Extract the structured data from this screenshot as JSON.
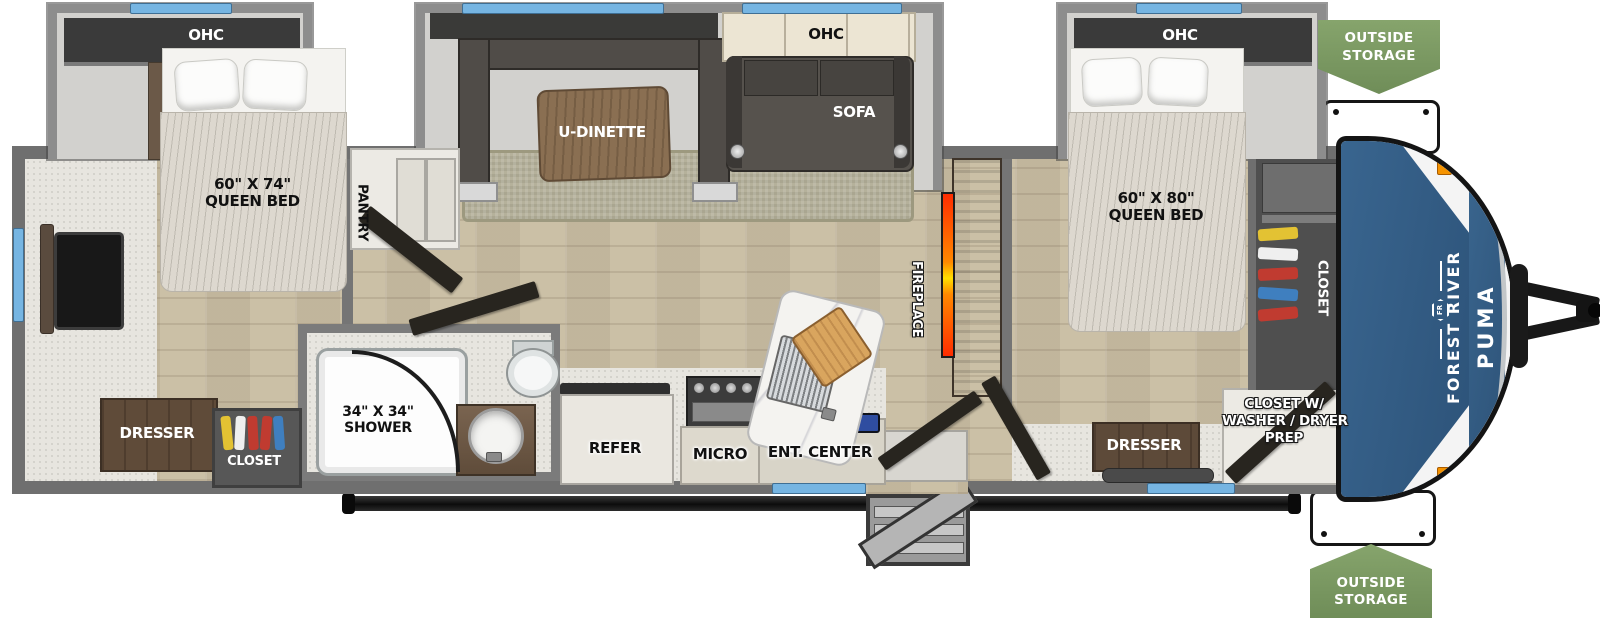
{
  "exterior": {
    "brand_vertical": "FOREST RIVER",
    "model_vertical": "PUMA",
    "logo_monogram": "FR",
    "storage_badge_top": {
      "line1": "OUTSIDE",
      "line2": "STORAGE"
    },
    "storage_badge_bottom": {
      "line1": "OUTSIDE",
      "line2": "STORAGE"
    }
  },
  "rear_bedroom": {
    "ohc_label": "OHC",
    "bed_size": "60\" X 74\"",
    "bed_type": "QUEEN BED",
    "dresser_label": "DRESSER",
    "closet_label": "CLOSET",
    "pantry_label": "PANTRY"
  },
  "bathroom": {
    "shower_size": "34\" X 34\"",
    "shower_label": "SHOWER"
  },
  "living_area": {
    "dinette_label": "U-DINETTE",
    "sofa_label": "SOFA",
    "ohc_label": "OHC",
    "fireplace_label": "FIREPLACE",
    "refrigerator_label": "REFER",
    "microwave_label": "MICRO",
    "entertainment_label": "ENT. CENTER"
  },
  "front_bedroom": {
    "ohc_label": "OHC",
    "bed_size": "60\" X 80\"",
    "bed_type": "QUEEN BED",
    "dresser_label": "DRESSER",
    "closet_label": "CLOSET",
    "washer_closet_line1": "CLOSET W/",
    "washer_closet_line2": "WASHER / DRYER",
    "washer_closet_line3": "PREP"
  },
  "colors": {
    "window_blue": "#76b5e2",
    "badge_green": "#7c9a62",
    "front_cap_blue": "#35618b",
    "flame_orange": "#ff7a00",
    "marker_orange": "#f59300",
    "wall_gray": "#6f6f6f",
    "floor_wood": "#cbc0a6"
  }
}
